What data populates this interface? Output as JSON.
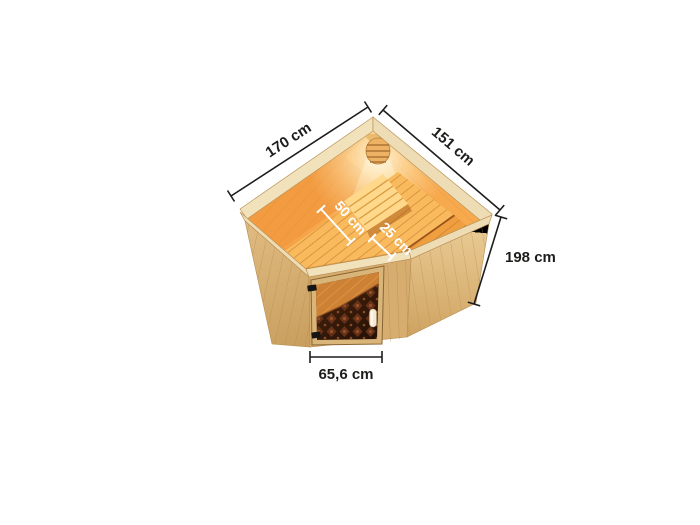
{
  "scene": {
    "description": "Top view 3D product rendering of a corner sauna with tinted glass door, interior benches, headrest and corner lamp, annotated with dimension lines",
    "background_color": "#ffffff"
  },
  "annotations": {
    "width_left": "170 cm",
    "width_right": "151 cm",
    "height": "198 cm",
    "bench_main_depth": "50 cm",
    "bench_lower_depth": "25 cm",
    "door_width": "65,6 cm"
  },
  "colors": {
    "dimension_line_dark": "#1d1d1b",
    "dimension_line_light": "#ffffff",
    "exterior_wood": "#dcb67c",
    "rim_wood": "#eedcb4",
    "interior_glow": "#f7a94e",
    "bench_wood": "#f8ba5c",
    "door_glass_dark": "#2a1408",
    "door_glass_pattern": "#6e3418",
    "hinge_black": "#151515",
    "handle_cream": "#f4ead2"
  }
}
